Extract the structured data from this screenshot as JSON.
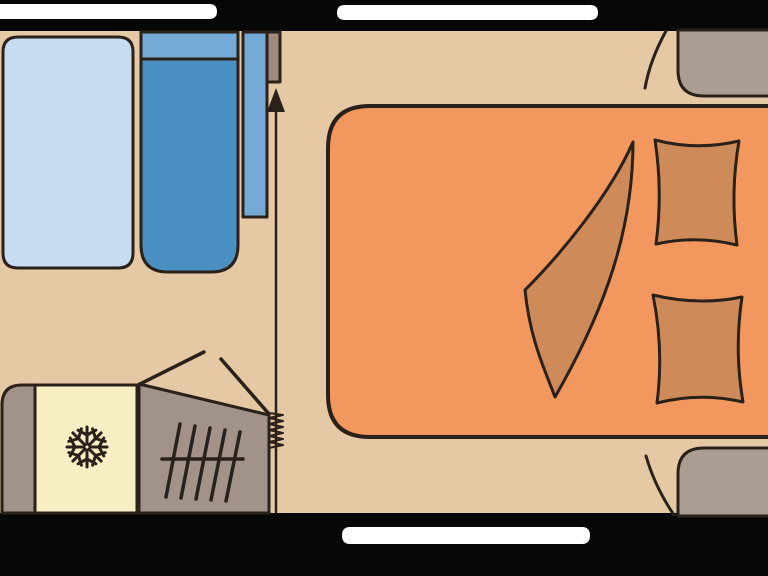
{
  "colors": {
    "floor": "#e5c8a4",
    "wall": "#070707",
    "window": "#ffffff",
    "outline": "#2a211a",
    "table": "#c7dbf2",
    "seat": "#4a90c2",
    "seat_back": "#74aad5",
    "wall_cabinet": "#a08a7d",
    "corner_unit": "#ac9d93",
    "bed": "#f2985e",
    "bedding": "#ce8b59",
    "fridge": "#f7efc3",
    "unit": "#a2938a"
  },
  "icons": {
    "snowflake": "❄",
    "arrow_up": "▲"
  },
  "paths": {
    "floor": "M0,0 H768 V576 H0 Z",
    "wall_top": "M0,0 H768 V31 H0 Z",
    "wall_bottom": "M0,513 H768 V576 H0 Z",
    "window_top_left": "M0,4 H209 Q217,4 217,11.5 Q217,19 209,19 H0 Z",
    "window_top_right": "M345,5 H590 Q598,5 598,12.5 Q598,20 590,20 H345 Q337,20 337,12.5 Q337,5 345,5 Z",
    "window_bottom": "M350,527 H582 Q590,527 590,535.5 Q590,544 582,544 H350 Q342,544 342,535.5 Q342,527 350,527 Z",
    "table": "M18,37 H118 Q133,37 133,52 V253 Q133,268 118,268 H18 Q3,268 3,253 V52 Q3,37 18,37 Z",
    "seat_backrest_top": "M141,32 H238 V59 H141 Z",
    "seat_cushion": "M141,59 H238 V245 Q238,272 211,272 H168 Q141,272 141,245 Z",
    "seat_backrest_side": "M243,32 H267 V217 H243 Z",
    "wall_cabinet": "M267,32 H280 V82 H267 Z",
    "bed": "M370,106 H798 V437 H370 Q328,437 328,395 V148 Q328,106 370,106 Z",
    "bed_throw": "M633,142 C610,195 560,255 525,290 C530,340 545,370 555,397 C605,310 633,230 633,142 Z",
    "pillow_top": "M655,140 Q697,151 739,141 Q730,193 737,245 Q696,235 656,244 Q663,192 655,140 Z",
    "pillow_bottom": "M653,295 Q698,306 742,297 Q734,350 743,402 Q700,392 657,403 Q664,349 653,295 Z",
    "corner_unit_top_right": "M678,30 H790 V96 H704 Q678,96 678,70 Z",
    "corner_unit_bottom_right": "M678,516 V474 Q678,448 704,448 H790 V516 Z",
    "curtain_arc_top": "M666,31 Q650,60 645,88",
    "curtain_arc_bottom": "M646,456 Q655,487 674,515",
    "kitchen_unit_end": "M35,385 H22 Q2,385 2,405 V513 H35 Z",
    "fridge": "M35,385 H137 V513 H35 Z",
    "snowflake": "M90,447 L107,447 M89.1,444.9 L101.1,432.9 M87,444 L87,427 M84.9,444.9 L72.9,432.9 M84,447 L67,447 M84.9,449.1 L72.9,461.1 M87,450 L87,467 M89.1,449.1 L101.1,461.1 M99,447 L103.8,438.1 M99,447 L103.8,455.9 M87,435 L78.1,430.2 M87,435 L95.9,430.2 M75,447 L70.2,438.1 M75,447 L70.2,455.9 M87,459 L78.1,463.8 M87,459 L95.9,463.8 M95.5,438.5 L92.6,428.8 M95.5,438.5 L105.2,441.4 M78.5,438.5 L81.4,428.8 M78.5,438.5 L68.8,441.4 M78.5,455.5 L68.8,452.6 M78.5,455.5 L81.4,465.2 M95.5,455.5 L92.6,465.2 M95.5,455.5 L105.2,452.6",
    "wardrobe": "M139,384 L269,415 V513 H139 Z",
    "wardrobe_rail": "M162,459 H243",
    "wardrobe_hangers": "M180,424 L166,497 M195,426 L181,498 M210,428 L196,499 M225,430 L211,500 M240,432 L226,501",
    "wardrobe_door_lines": "M140,384 L204,352 M221,359 L269,414",
    "door_slide_line": "M276,110 V512",
    "door_slide_arrowhead": "M276,88 L267,112 L285,112 Z",
    "concertina_coil": "M269,413 L283,415 L269,418 L283,421 L269,424 L283,427 L269,430 L283,433 L269,436 L283,439 L269,442 L283,445 L269,448"
  }
}
